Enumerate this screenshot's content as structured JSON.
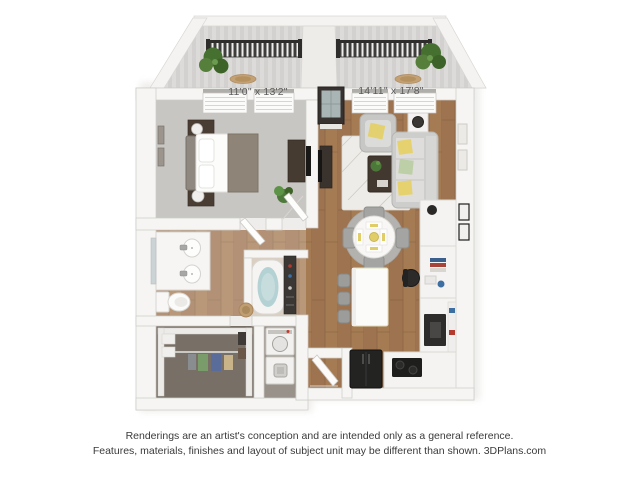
{
  "plan": {
    "bedroom": {
      "dimensions": "11'0\" x 13'2\""
    },
    "living_room": {
      "dimensions": "14'11\" x 17'8\""
    },
    "rooms": [
      "balcony-left",
      "balcony-right",
      "bedroom",
      "living-room",
      "bathroom",
      "walk-in-closet",
      "laundry-nook",
      "dining-area",
      "kitchen",
      "entry"
    ]
  },
  "disclaimer": {
    "line1": "Renderings are an artist's conception and are intended only as a general reference.",
    "line2": "Features, materials, finishes and layout of subject unit may be different than shown. 3DPlans.com"
  },
  "colors": {
    "background": "#ffffff",
    "wall": "#f6f5f3",
    "wall_edge": "#cdcbc7",
    "wood_floor": "#a57b54",
    "bedroom_carpet": "#c8c6c2",
    "balcony_deck": "#dcdbd9",
    "railing_dark": "#3e3d3b",
    "plant_green": "#46702f",
    "sofa_gray": "#cdcdcb",
    "pillow_yellow": "#e5d26e",
    "pillow_green": "#bccfa6",
    "dark_furniture": "#463b31",
    "appliance_black": "#232322",
    "tub_water": "#b4d2d4",
    "dimension_text": "#5c5c5c",
    "disclaimer_text": "#3a3a3a"
  }
}
